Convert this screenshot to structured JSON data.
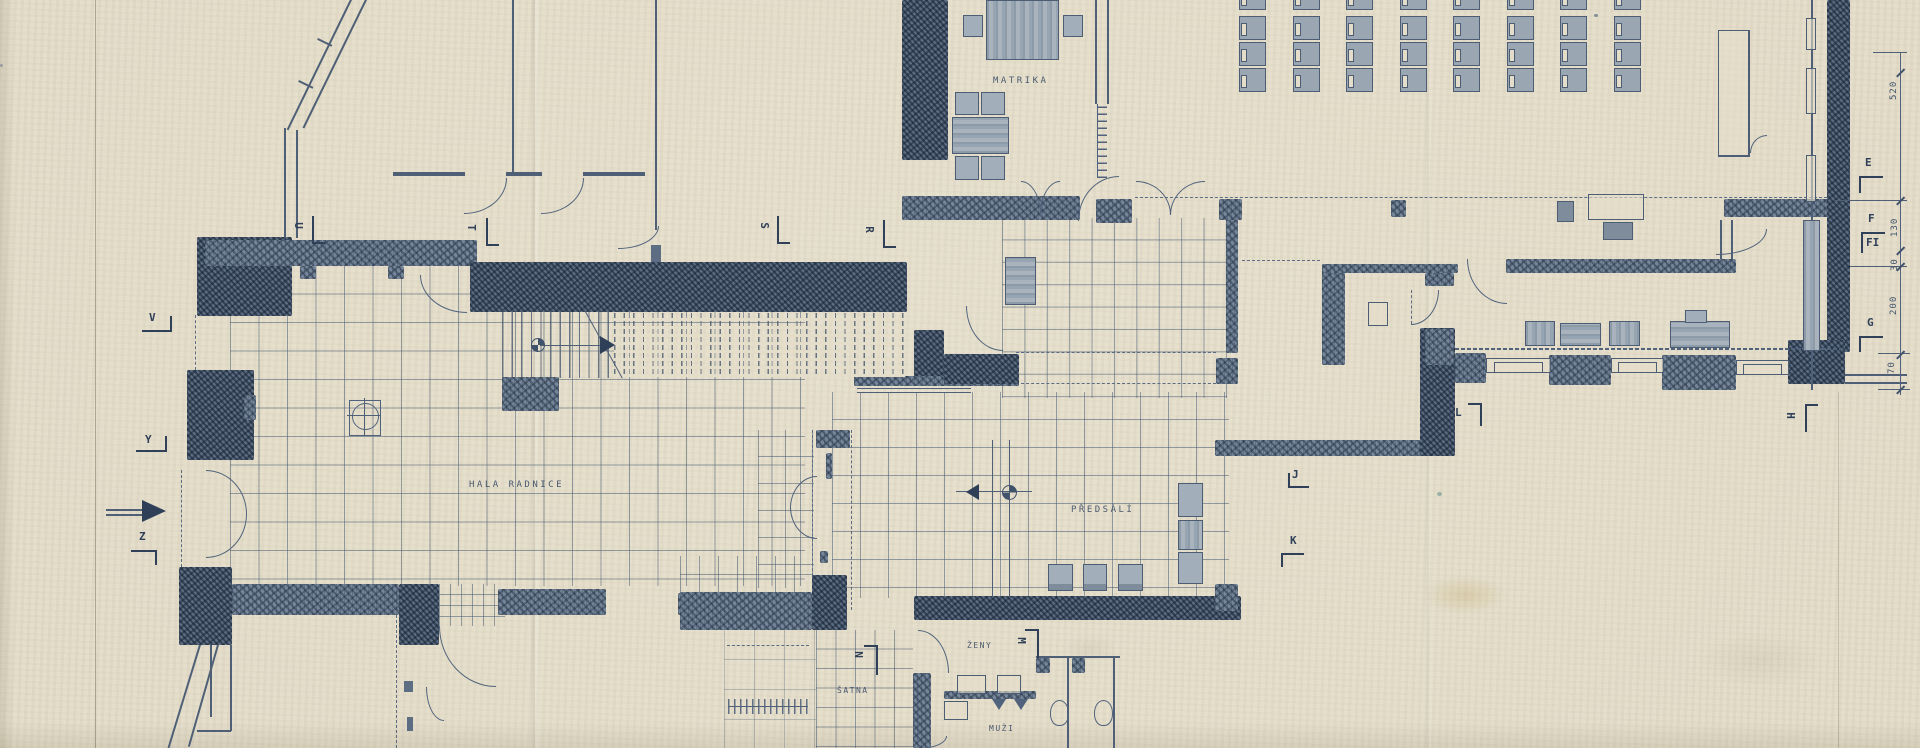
{
  "sheet": {
    "width": 1920,
    "height": 748,
    "paper_color": "#e4ddc9",
    "ink_color": "#4f6076",
    "wall_fill": "#76869a"
  },
  "room_labels": [
    {
      "id": "matrika",
      "text": "MATRIKA",
      "x": 993,
      "y": 76
    },
    {
      "id": "hala",
      "text": "HALA RADNICE",
      "x": 469,
      "y": 480
    },
    {
      "id": "predsali",
      "text": "PŘEDSÁLÍ",
      "x": 1071,
      "y": 505
    },
    {
      "id": "satna",
      "text": "ŠATNA",
      "x": 837,
      "y": 686,
      "small": true
    },
    {
      "id": "zeny",
      "text": "ŽENY",
      "x": 967,
      "y": 641,
      "small": true
    },
    {
      "id": "muzi",
      "text": "MUŽI",
      "x": 989,
      "y": 724,
      "small": true
    }
  ],
  "section_markers": [
    {
      "label": "U",
      "x": 295,
      "y": 219,
      "rot": 90,
      "segs": [
        [
          312,
          216,
          2,
          28
        ],
        [
          312,
          242,
          13,
          2
        ]
      ]
    },
    {
      "label": "T",
      "x": 468,
      "y": 221,
      "rot": 90,
      "segs": [
        [
          486,
          218,
          2,
          28
        ],
        [
          486,
          244,
          13,
          2
        ]
      ]
    },
    {
      "label": "S",
      "x": 761,
      "y": 219,
      "rot": 90,
      "segs": [
        [
          777,
          216,
          2,
          28
        ],
        [
          777,
          242,
          13,
          2
        ]
      ]
    },
    {
      "label": "R",
      "x": 866,
      "y": 223,
      "rot": 90,
      "segs": [
        [
          883,
          220,
          2,
          28
        ],
        [
          883,
          246,
          13,
          2
        ]
      ]
    },
    {
      "label": "V",
      "x": 149,
      "y": 311,
      "rot": 0,
      "segs": [
        [
          142,
          330,
          30,
          2
        ],
        [
          170,
          316,
          2,
          15
        ]
      ]
    },
    {
      "label": "Y",
      "x": 145,
      "y": 433,
      "rot": 0,
      "segs": [
        [
          136,
          450,
          31,
          2
        ],
        [
          165,
          436,
          2,
          15
        ]
      ]
    },
    {
      "label": "Z",
      "x": 139,
      "y": 530,
      "rot": 0,
      "segs": [
        [
          131,
          550,
          26,
          2
        ],
        [
          155,
          550,
          2,
          15
        ]
      ]
    },
    {
      "label": "E",
      "x": 1865,
      "y": 156,
      "rot": 0,
      "segs": [
        [
          1859,
          176,
          24,
          2
        ],
        [
          1859,
          176,
          2,
          17
        ]
      ]
    },
    {
      "label": "F",
      "x": 1868,
      "y": 212,
      "rot": 0,
      "segs": [
        [
          1861,
          232,
          24,
          2
        ],
        [
          1861,
          232,
          2,
          21
        ]
      ]
    },
    {
      "label": "FI",
      "x": 1866,
      "y": 236,
      "rot": 0,
      "segs": []
    },
    {
      "label": "G",
      "x": 1867,
      "y": 316,
      "rot": 0,
      "segs": [
        [
          1859,
          336,
          24,
          2
        ],
        [
          1859,
          336,
          2,
          16
        ]
      ]
    },
    {
      "label": "H",
      "x": 1787,
      "y": 409,
      "rot": 90,
      "segs": [
        [
          1805,
          404,
          2,
          28
        ],
        [
          1805,
          404,
          13,
          2
        ]
      ]
    },
    {
      "label": "J",
      "x": 1292,
      "y": 468,
      "rot": 0,
      "segs": [
        [
          1288,
          486,
          21,
          2
        ],
        [
          1288,
          473,
          2,
          14
        ]
      ]
    },
    {
      "label": "K",
      "x": 1290,
      "y": 534,
      "rot": 0,
      "segs": [
        [
          1281,
          553,
          23,
          2
        ],
        [
          1281,
          553,
          2,
          14
        ]
      ]
    },
    {
      "label": "L",
      "x": 1455,
      "y": 406,
      "rot": 0,
      "segs": [
        [
          1468,
          403,
          14,
          2
        ],
        [
          1480,
          403,
          2,
          23
        ]
      ]
    },
    {
      "label": "M",
      "x": 1018,
      "y": 634,
      "rot": 90,
      "segs": [
        [
          1037,
          629,
          2,
          29
        ],
        [
          1025,
          629,
          13,
          2
        ]
      ]
    },
    {
      "label": "N",
      "x": 855,
      "y": 648,
      "rot": 90,
      "segs": [
        [
          876,
          645,
          2,
          30
        ],
        [
          864,
          645,
          13,
          2
        ]
      ]
    }
  ],
  "dimension_chain": {
    "values": [
      {
        "v": "520",
        "x": 1889,
        "y": 100
      },
      {
        "v": "130",
        "x": 1890,
        "y": 237
      },
      {
        "v": "30",
        "x": 1890,
        "y": 271
      },
      {
        "v": "200",
        "x": 1889,
        "y": 315
      },
      {
        "v": "70",
        "x": 1887,
        "y": 374
      }
    ],
    "line": {
      "x": 1900,
      "y": 52,
      "h": 343
    },
    "ticks_y": [
      72,
      200,
      250,
      266,
      354,
      389
    ]
  },
  "hall_seating": {
    "cols": 8,
    "rows_y": [
      -14,
      16,
      42,
      68
    ],
    "x0": 1239,
    "dx": 53.5,
    "seat_w": 25,
    "seat_h": 22,
    "clipped_top_row": true
  },
  "symbols": {
    "entrance_arrow": {
      "x": 140,
      "y": 502
    },
    "stair_arrow": {
      "x": 603,
      "y": 338
    },
    "survey_points": [
      {
        "x": 531,
        "y": 338,
        "d": 12
      },
      {
        "x": 1002,
        "y": 485,
        "d": 13
      }
    ]
  }
}
